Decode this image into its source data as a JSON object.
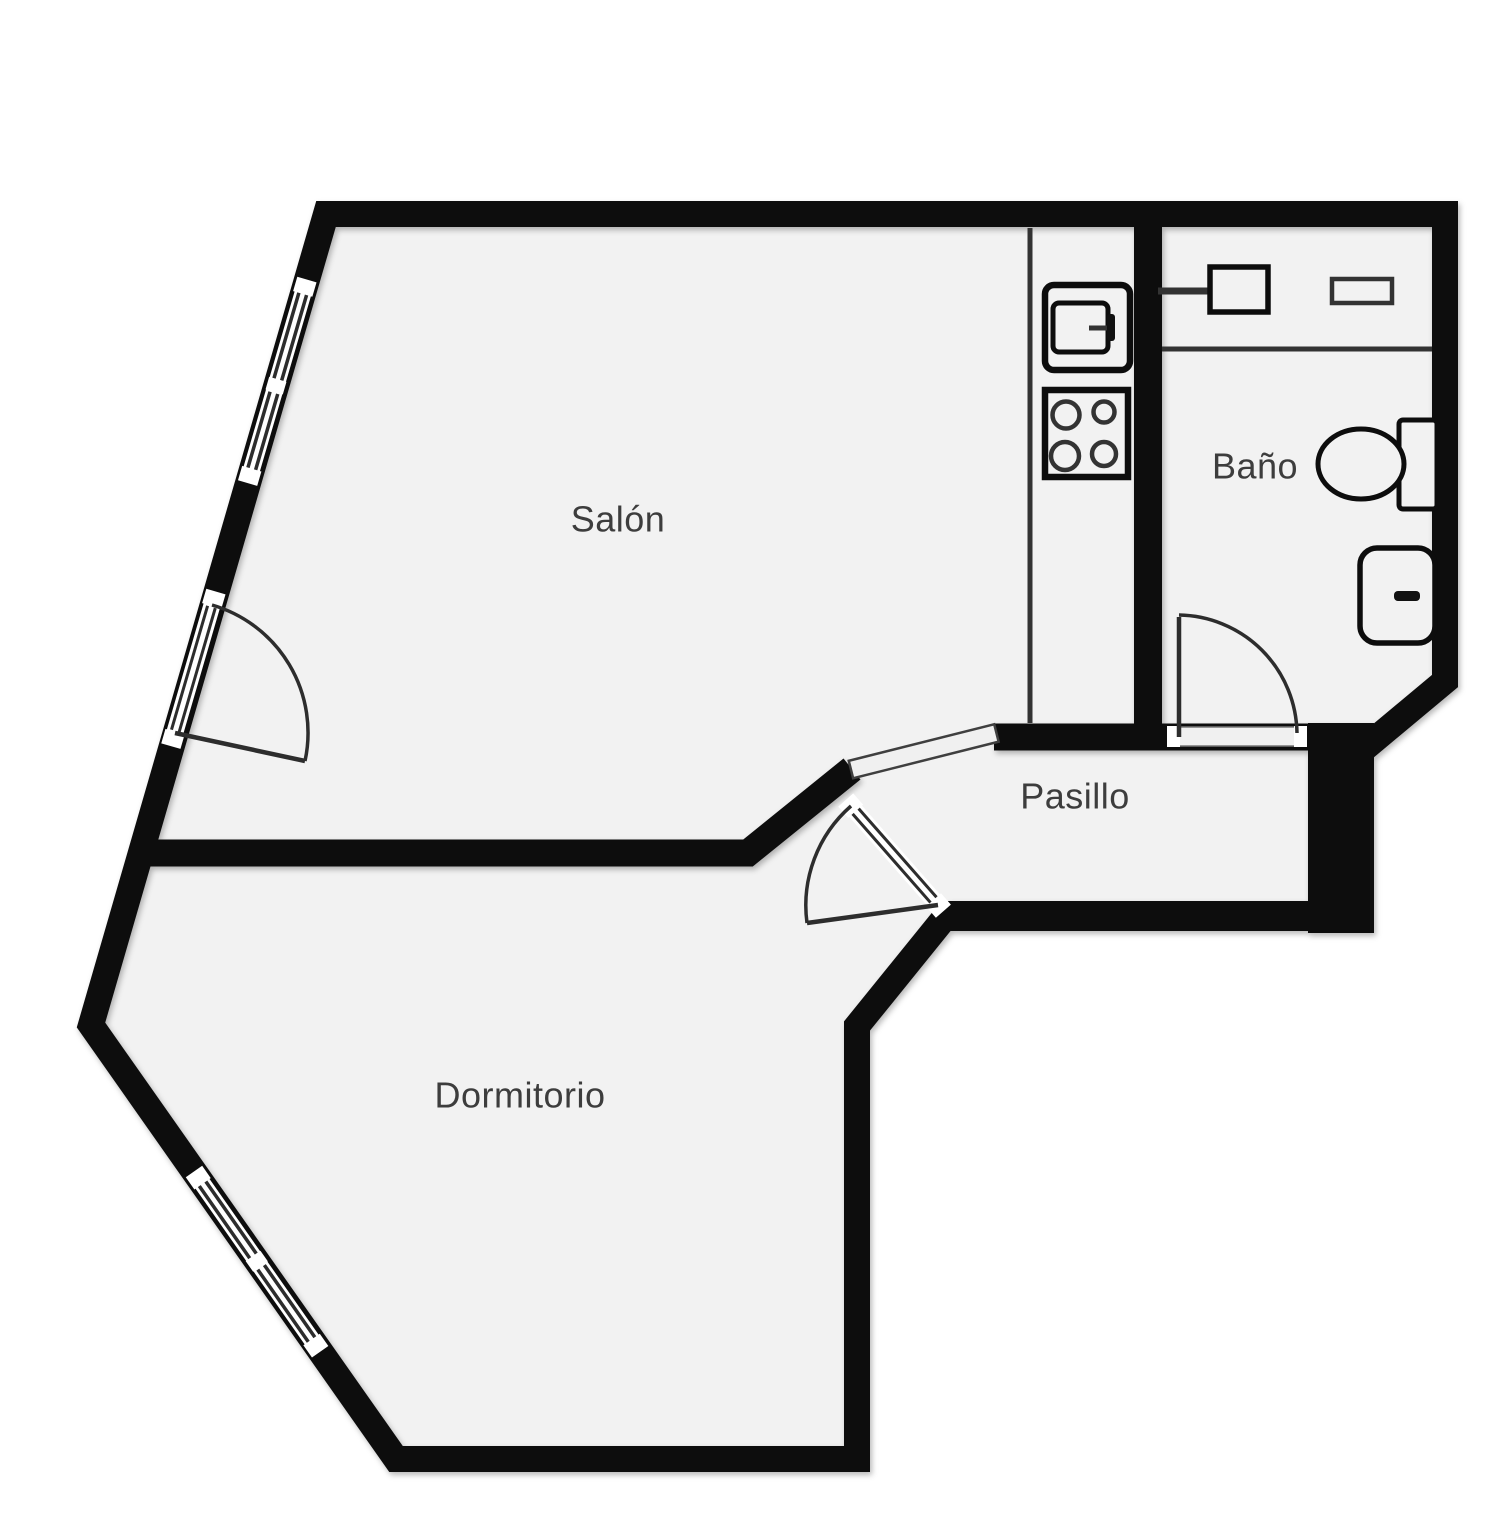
{
  "title": "Apartment floor plan",
  "rooms": {
    "salon": {
      "label": "Salón"
    },
    "bano": {
      "label": "Baño"
    },
    "pasillo": {
      "label": "Pasillo"
    },
    "dormitorio": {
      "label": "Dormitorio"
    }
  },
  "fixtures": {
    "kitchen": [
      "kitchen-sink-icon",
      "stove-4-burner-icon",
      "counter-line"
    ],
    "bathroom": [
      "washbasin-icon",
      "faucet-icon",
      "shelf-icon",
      "toilet-icon",
      "bidet-icon",
      "counter-line"
    ],
    "doors": [
      "salon-entry-door-swing",
      "bano-door-swing",
      "dormitorio-door-swing"
    ],
    "windows": [
      "salon-left-wall-window",
      "dormitorio-left-wall-window"
    ],
    "openings": [
      "salon-pasillo-opening"
    ]
  },
  "colors": {
    "wall": "#0d0d0d",
    "floor": "#f2f2f2",
    "background": "#ffffff",
    "label": "#3d3d3d",
    "threshold": "#f0f0f0"
  }
}
